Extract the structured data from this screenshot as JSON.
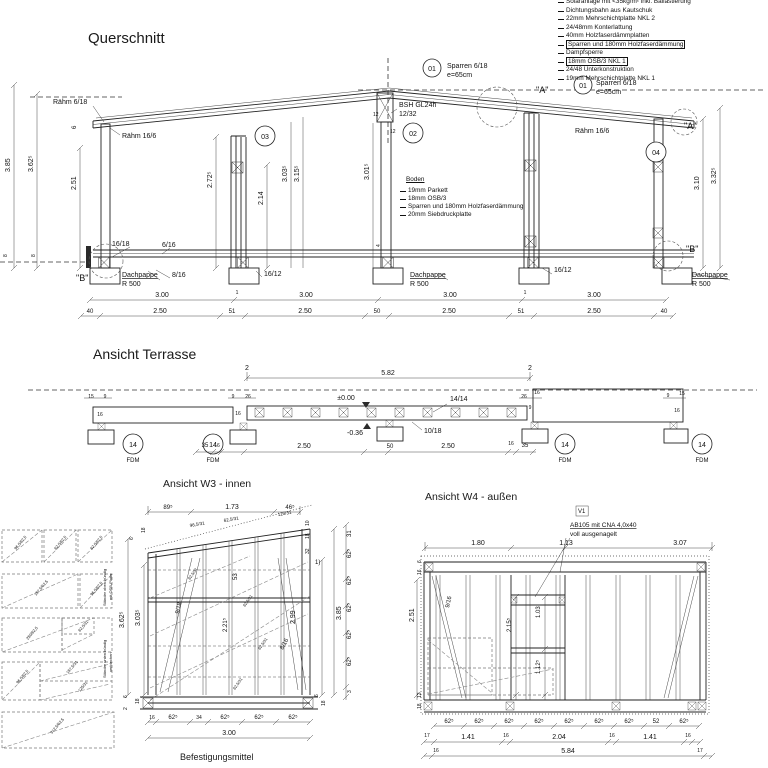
{
  "drawing": {
    "titles": {
      "querschnitt": "Querschnitt",
      "ansicht_terrasse": "Ansicht Terrasse",
      "ansicht_w3": "Ansicht W3 - innen",
      "ansicht_w4": "Ansicht W4 - außen",
      "befestigungsmittel": "Befestigungsmittel"
    },
    "roof_legend": {
      "items": [
        {
          "text": "Solaranlage mit <35kg/m² inkl. Ballastierung",
          "boxed": false
        },
        {
          "text": "Dichtungsbahn aus Kautschuk",
          "boxed": false
        },
        {
          "text": "22mm Mehrschichtplatte NKL 2",
          "boxed": false
        },
        {
          "text": "24/48mm Konterlattung",
          "boxed": false
        },
        {
          "text": "40mm Holzfaserdämmplatten",
          "boxed": false
        },
        {
          "text": "Sparren und 180mm Holzfaserdämmung",
          "boxed": true
        },
        {
          "text": "Dampfsperre",
          "boxed": false
        },
        {
          "text": "18mm OSB/3 NKL 1",
          "boxed": true
        },
        {
          "text": "24/48 Unterkonstruktion",
          "boxed": false
        },
        {
          "text": "19mm Mehrschichtplatte NKL 1",
          "boxed": false
        }
      ]
    },
    "boden_legend": {
      "title": "Boden",
      "items": [
        {
          "text": "19mm Parkett",
          "boxed": false
        },
        {
          "text": "18mm OSB/3",
          "boxed": false
        },
        {
          "text": "Sparren und 180mm Holzfaserdämmung",
          "boxed": false
        },
        {
          "text": "20mm Siebdruckplatte",
          "boxed": false
        }
      ]
    },
    "labels": [
      [
        "Rähm 6/18",
        53,
        104,
        0,
        7
      ],
      [
        "Rähm 16/6",
        122,
        138,
        0,
        7
      ],
      [
        "01",
        432,
        71,
        0,
        7,
        "m"
      ],
      [
        "Sparren 6/18",
        447,
        68,
        0,
        7
      ],
      [
        "e=65cm",
        447,
        77,
        0,
        7
      ],
      [
        "01",
        583,
        88,
        0,
        7,
        "m"
      ],
      [
        "Sparren 6/18",
        596,
        85,
        0,
        7
      ],
      [
        "e=65cm",
        596,
        94,
        0,
        7
      ],
      [
        "BSH GL24h",
        399,
        107,
        0,
        7
      ],
      [
        "12/32",
        399,
        116,
        0,
        7
      ],
      [
        "02",
        413,
        136,
        0,
        7,
        "m"
      ],
      [
        "03",
        265,
        139,
        0,
        7,
        "m"
      ],
      [
        "04",
        656,
        155,
        0,
        7,
        "m"
      ],
      [
        "Rähm 16/6",
        575,
        133,
        0,
        7
      ],
      [
        "\"A\"",
        536,
        93,
        0,
        9
      ],
      [
        "\"A\"",
        684,
        129,
        0,
        9
      ],
      [
        "\"B\"",
        76,
        281,
        0,
        9
      ],
      [
        "\"B\"",
        686,
        252,
        0,
        9
      ],
      [
        "12",
        373,
        116,
        0,
        5
      ],
      [
        "12",
        390,
        133,
        0,
        5
      ],
      [
        "3.85",
        10,
        172,
        -90,
        7
      ],
      [
        "3.62⁵",
        33,
        172,
        -90,
        7
      ],
      [
        "2.51",
        76,
        190,
        -90,
        7
      ],
      [
        "2.72⁵",
        212,
        188,
        -90,
        7
      ],
      [
        "2.14",
        263,
        205,
        -90,
        7
      ],
      [
        "3.03⁵",
        287,
        182,
        -90,
        7
      ],
      [
        "3.15⁵",
        299,
        182,
        -90,
        7
      ],
      [
        "3.01⁵",
        369,
        180,
        -90,
        7
      ],
      [
        "3.10",
        699,
        190,
        -90,
        7
      ],
      [
        "3.32⁵",
        716,
        184,
        -90,
        7
      ],
      [
        "6",
        76,
        129,
        -90,
        6
      ],
      [
        "4",
        380,
        247,
        -90,
        5
      ],
      [
        "8",
        7,
        257,
        -90,
        5
      ],
      [
        "8",
        35,
        257,
        -90,
        5
      ],
      [
        "16/18",
        112,
        246,
        0,
        7
      ],
      [
        "6/16",
        162,
        247,
        0,
        7
      ],
      [
        "8/16",
        172,
        277,
        0,
        7
      ],
      [
        "Dachpappe",
        122,
        277,
        0,
        7,
        "u"
      ],
      [
        "R 500",
        122,
        286,
        0,
        7
      ],
      [
        "16/12",
        264,
        276,
        0,
        7
      ],
      [
        "Dachpappe",
        410,
        277,
        0,
        7,
        "u"
      ],
      [
        "R 500",
        410,
        286,
        0,
        7
      ],
      [
        "16/12",
        554,
        272,
        0,
        7
      ],
      [
        "Dachpappe",
        692,
        277,
        0,
        7,
        "u"
      ],
      [
        "R 500",
        692,
        286,
        0,
        7
      ],
      [
        "3.00",
        162,
        297,
        0,
        7,
        "m"
      ],
      [
        "3.00",
        306,
        297,
        0,
        7,
        "m"
      ],
      [
        "3.00",
        450,
        297,
        0,
        7,
        "m"
      ],
      [
        "3.00",
        594,
        297,
        0,
        7,
        "m"
      ],
      [
        "1",
        237,
        294,
        0,
        5,
        "m"
      ],
      [
        "1",
        525,
        294,
        0,
        5,
        "m"
      ],
      [
        "40",
        90,
        313,
        0,
        6,
        "m"
      ],
      [
        "2.50",
        160,
        313,
        0,
        7,
        "m"
      ],
      [
        "51",
        232,
        313,
        0,
        6,
        "m"
      ],
      [
        "2.50",
        305,
        313,
        0,
        7,
        "m"
      ],
      [
        "50",
        377,
        313,
        0,
        6,
        "m"
      ],
      [
        "2.50",
        449,
        313,
        0,
        7,
        "m"
      ],
      [
        "51",
        521,
        313,
        0,
        6,
        "m"
      ],
      [
        "2.50",
        594,
        313,
        0,
        7,
        "m"
      ],
      [
        "40",
        664,
        313,
        0,
        6,
        "m"
      ],
      [
        "2",
        247,
        370,
        0,
        7,
        "m"
      ],
      [
        "2",
        530,
        370,
        0,
        7,
        "m"
      ],
      [
        "5.82",
        388,
        375,
        0,
        7,
        "m"
      ],
      [
        "±0.00",
        346,
        400,
        0,
        7,
        "m"
      ],
      [
        "-0.36",
        355,
        435,
        0,
        7,
        "m"
      ],
      [
        "14/14",
        450,
        401,
        0,
        7
      ],
      [
        "10/18",
        424,
        433,
        0,
        7
      ],
      [
        "15",
        91,
        398,
        0,
        5,
        "m"
      ],
      [
        "9",
        105,
        398,
        0,
        5,
        "m"
      ],
      [
        "16",
        100,
        416,
        0,
        5,
        "m"
      ],
      [
        "9",
        233,
        398,
        0,
        5,
        "m"
      ],
      [
        "26",
        248,
        398,
        0,
        5,
        "m"
      ],
      [
        "16",
        238,
        415,
        0,
        5,
        "m"
      ],
      [
        "26",
        524,
        398,
        0,
        5,
        "m"
      ],
      [
        "16",
        537,
        394,
        0,
        5,
        "m"
      ],
      [
        "9",
        530,
        409,
        0,
        5,
        "m"
      ],
      [
        "9",
        668,
        397,
        0,
        5,
        "m"
      ],
      [
        "15",
        682,
        395,
        0,
        5,
        "m"
      ],
      [
        "16",
        677,
        412,
        0,
        5,
        "m"
      ],
      [
        "35",
        205,
        447,
        0,
        6,
        "m"
      ],
      [
        "16",
        217,
        447,
        0,
        5,
        "m"
      ],
      [
        "2.50",
        304,
        448,
        0,
        7,
        "m"
      ],
      [
        "50",
        390,
        448,
        0,
        6,
        "m"
      ],
      [
        "2.50",
        448,
        448,
        0,
        7,
        "m"
      ],
      [
        "16",
        511,
        445,
        0,
        5,
        "m"
      ],
      [
        "35",
        525,
        447,
        0,
        6,
        "m"
      ],
      [
        "14",
        133,
        447,
        0,
        7,
        "m"
      ],
      [
        "FDM",
        133,
        462,
        0,
        6,
        "m"
      ],
      [
        "14",
        213,
        447,
        0,
        7,
        "m"
      ],
      [
        "FDM",
        213,
        462,
        0,
        6,
        "m"
      ],
      [
        "14",
        565,
        447,
        0,
        7,
        "m"
      ],
      [
        "FDM",
        565,
        462,
        0,
        6,
        "m"
      ],
      [
        "14",
        702,
        447,
        0,
        7,
        "m"
      ],
      [
        "FDM",
        702,
        462,
        0,
        6,
        "m"
      ],
      [
        "89⁵",
        168,
        509,
        0,
        6,
        "m"
      ],
      [
        "1.73",
        232,
        509,
        0,
        7,
        "m"
      ],
      [
        "46⁵",
        290,
        509,
        0,
        6,
        "m"
      ],
      [
        "96,5/31",
        190,
        527,
        -10,
        4.5
      ],
      [
        "62,5/31",
        224,
        522,
        -10,
        4.5
      ],
      [
        "125/31",
        278,
        516,
        -10,
        4.5
      ],
      [
        "Ständer oben bündig",
        106,
        606,
        -90,
        4
      ],
      [
        "mit OSB-Platte",
        112,
        600,
        -90,
        4
      ],
      [
        "Ständer unten bündig",
        106,
        678,
        -90,
        4
      ],
      [
        "verblechen",
        112,
        672,
        -90,
        4
      ],
      [
        "6",
        133,
        540,
        -90,
        5
      ],
      [
        "18",
        145,
        533,
        -90,
        5
      ],
      [
        "3.62⁵",
        124,
        628,
        -90,
        7
      ],
      [
        "3.03⁵",
        140,
        626,
        -90,
        7
      ],
      [
        "6",
        127,
        698,
        -90,
        5
      ],
      [
        "2",
        127,
        710,
        -90,
        5
      ],
      [
        "18",
        139,
        704,
        -90,
        5
      ],
      [
        "53",
        237,
        580,
        -90,
        6
      ],
      [
        "9/18",
        179,
        614,
        -78,
        6
      ],
      [
        "2.21⁵",
        227,
        632,
        -90,
        6
      ],
      [
        "8/16",
        283,
        650,
        -62,
        6
      ],
      [
        "2.99",
        295,
        624,
        -90,
        7
      ],
      [
        "3.85",
        341,
        620,
        -90,
        7
      ],
      [
        "62,5/31",
        190,
        580,
        -55,
        4
      ],
      [
        "62,5/31",
        245,
        607,
        -55,
        4
      ],
      [
        "62,5/31",
        260,
        650,
        -55,
        4
      ],
      [
        "62,5/31",
        235,
        690,
        -55,
        4
      ],
      [
        "10",
        309,
        526,
        -90,
        5
      ],
      [
        "18",
        309,
        539,
        -90,
        5
      ],
      [
        "32",
        309,
        554,
        -90,
        5
      ],
      [
        "1)",
        315,
        564,
        0,
        6
      ],
      [
        "31",
        351,
        537,
        -90,
        6
      ],
      [
        "62⁵",
        351,
        558,
        -90,
        6
      ],
      [
        "62⁵",
        351,
        585,
        -90,
        6
      ],
      [
        "62⁵",
        351,
        612,
        -90,
        6
      ],
      [
        "62⁵",
        351,
        639,
        -90,
        6
      ],
      [
        "62⁵",
        351,
        666,
        -90,
        6
      ],
      [
        "3",
        351,
        693,
        -90,
        5
      ],
      [
        "6",
        318,
        697,
        -90,
        5
      ],
      [
        "18",
        325,
        706,
        -90,
        5
      ],
      [
        "16",
        152,
        719,
        0,
        5,
        "m"
      ],
      [
        "62⁵",
        173,
        719,
        0,
        6,
        "m"
      ],
      [
        "34",
        199,
        719,
        0,
        5,
        "m"
      ],
      [
        "62⁵",
        225,
        719,
        0,
        6,
        "m"
      ],
      [
        "62⁵",
        259,
        719,
        0,
        6,
        "m"
      ],
      [
        "62⁵",
        293,
        719,
        0,
        6,
        "m"
      ],
      [
        "3.00",
        229,
        735,
        0,
        7,
        "m"
      ],
      [
        "V1",
        578,
        513,
        0,
        6,
        "bx"
      ],
      [
        "AB105 mit CNA 4,0x40",
        570,
        527,
        0,
        6.5,
        "u"
      ],
      [
        "voll ausgenagelt",
        570,
        536,
        0,
        6.5
      ],
      [
        "1.80",
        478,
        545,
        0,
        7,
        "m"
      ],
      [
        "1.13",
        566,
        545,
        0,
        7,
        "m"
      ],
      [
        "3.07",
        680,
        545,
        0,
        7,
        "m"
      ],
      [
        "9/16",
        449,
        608,
        -78,
        6
      ],
      [
        "2.15⁵",
        511,
        632,
        -90,
        6
      ],
      [
        "1.03",
        540,
        618,
        -90,
        6
      ],
      [
        "1.12⁵",
        540,
        674,
        -90,
        6
      ],
      [
        "2.51",
        414,
        622,
        -90,
        7
      ],
      [
        "6",
        421,
        563,
        -90,
        5
      ],
      [
        "16",
        421,
        575,
        -90,
        5
      ],
      [
        "12",
        421,
        698,
        -90,
        5
      ],
      [
        "18",
        421,
        709,
        -90,
        5
      ],
      [
        "62⁵",
        449,
        723,
        0,
        6,
        "m"
      ],
      [
        "62⁵",
        479,
        723,
        0,
        6,
        "m"
      ],
      [
        "62⁵",
        509,
        723,
        0,
        6,
        "m"
      ],
      [
        "62⁵",
        539,
        723,
        0,
        6,
        "m"
      ],
      [
        "62⁵",
        569,
        723,
        0,
        6,
        "m"
      ],
      [
        "62⁵",
        599,
        723,
        0,
        6,
        "m"
      ],
      [
        "62⁵",
        629,
        723,
        0,
        6,
        "m"
      ],
      [
        "52",
        656,
        723,
        0,
        6,
        "m"
      ],
      [
        "62⁵",
        684,
        723,
        0,
        6,
        "m"
      ],
      [
        "17",
        427,
        737,
        0,
        5,
        "m"
      ],
      [
        "1.41",
        468,
        739,
        0,
        7,
        "m"
      ],
      [
        "16",
        506,
        737,
        0,
        5,
        "m"
      ],
      [
        "2.04",
        559,
        739,
        0,
        7,
        "m"
      ],
      [
        "16",
        612,
        737,
        0,
        5,
        "m"
      ],
      [
        "1.41",
        650,
        739,
        0,
        7,
        "m"
      ],
      [
        "16",
        688,
        737,
        0,
        5,
        "m"
      ],
      [
        "16",
        436,
        752,
        0,
        5,
        "m"
      ],
      [
        "5.84",
        568,
        753,
        0,
        7,
        "m"
      ],
      [
        "17",
        700,
        752,
        0,
        5,
        "m"
      ],
      [
        "96,5/62,5",
        16,
        550,
        -50,
        4
      ],
      [
        "62,5/62,5",
        56,
        550,
        -50,
        4
      ],
      [
        "62,5/62,5",
        92,
        550,
        -50,
        4
      ],
      [
        "187,5/62,5",
        36,
        596,
        -50,
        4
      ],
      [
        "96,5/62,5",
        92,
        596,
        -50,
        4
      ],
      [
        "250/62,5",
        28,
        640,
        -50,
        4
      ],
      [
        "62,5/31",
        80,
        632,
        -50,
        4
      ],
      [
        "96,5/62,5",
        18,
        684,
        -50,
        4
      ],
      [
        "187,5/31",
        68,
        674,
        -50,
        4
      ],
      [
        "125/31",
        80,
        692,
        -50,
        4
      ],
      [
        "312,5/62,5",
        52,
        734,
        -50,
        4
      ]
    ]
  }
}
